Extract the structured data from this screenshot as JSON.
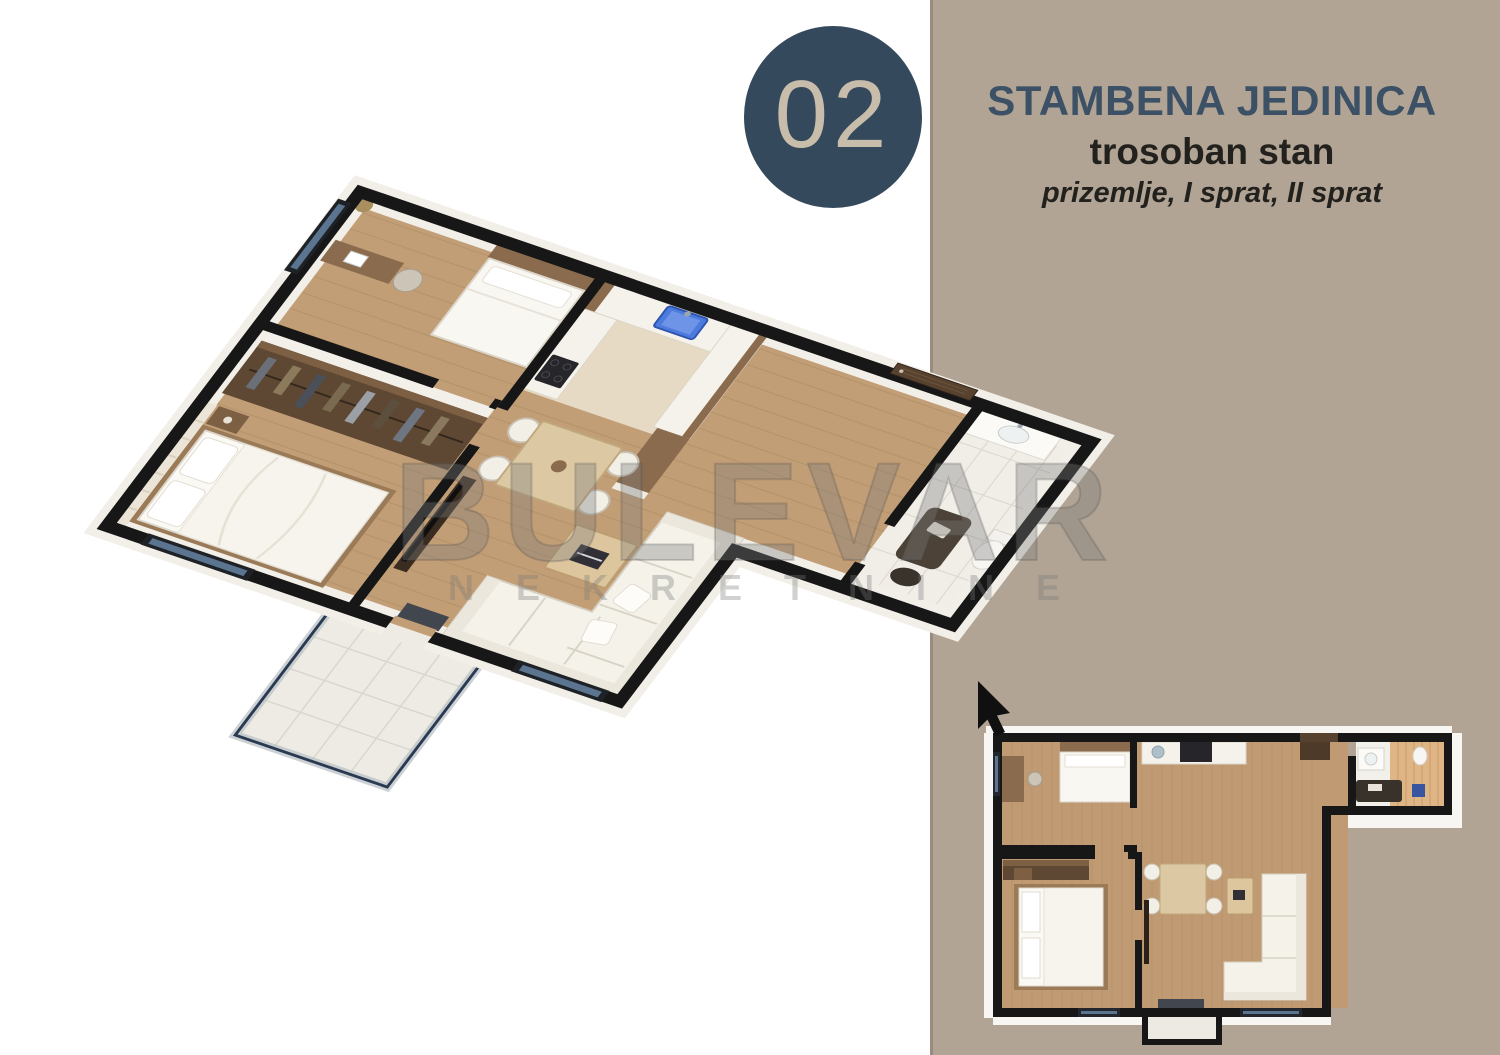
{
  "page": {
    "background_color": "#ffffff"
  },
  "side_panel": {
    "background_color": "#b1a494"
  },
  "unit_badge": {
    "number": "02",
    "circle_color": "#35495c",
    "number_color": "#c8bdab"
  },
  "header": {
    "title": "STAMBENA JEDINICA",
    "subtitle": "trosoban stan",
    "floors_note": "prizemlje, I sprat, II sprat",
    "title_color": "#3d5166",
    "text_color": "#23211e"
  },
  "watermark": {
    "line1": "BULEVAR",
    "line2": "N E K R E T N I N E"
  },
  "floor_plans": {
    "main_view": "3d-isometric-floor-plan",
    "mini_view": "2d-top-down-floor-plan",
    "colors": {
      "walls": "#171717",
      "wood_floor": "#c29e76",
      "white_surfaces": "#f5f2ea",
      "dark_wood": "#5f4833",
      "kitchen_sink_blue": "#4c7ade",
      "bathroom_tile": "#e0b586",
      "window_glass_blue": "#5b7590",
      "balcony_tile": "#edebe4"
    }
  },
  "cursor": {
    "color": "#101010"
  }
}
